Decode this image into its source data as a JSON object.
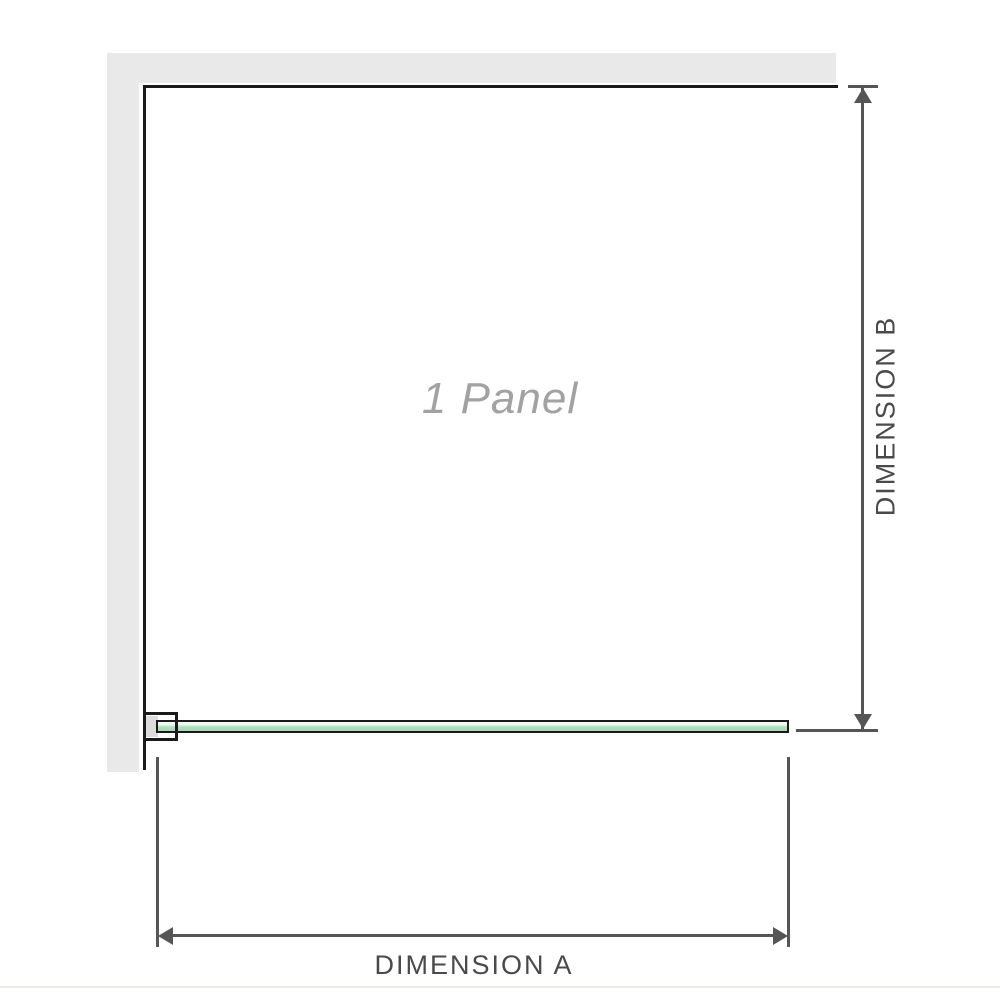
{
  "diagram": {
    "panel_label": "1 Panel",
    "dimension_a": {
      "label": "DIMENSION A"
    },
    "dimension_b": {
      "label": "DIMENSION B"
    },
    "colors": {
      "wall": "#e9e9e9",
      "outline": "#1a1a1a",
      "dimension_line": "#555555",
      "dimension_text": "#4a4a4a",
      "panel_label_text": "#a2a2a2",
      "glass_fill": "#a4d9b4",
      "glass_highlight": "#f2fbf4",
      "bracket_fill": "#dcdcdc",
      "footer_rule": "#edebe7",
      "background": "#ffffff"
    }
  }
}
